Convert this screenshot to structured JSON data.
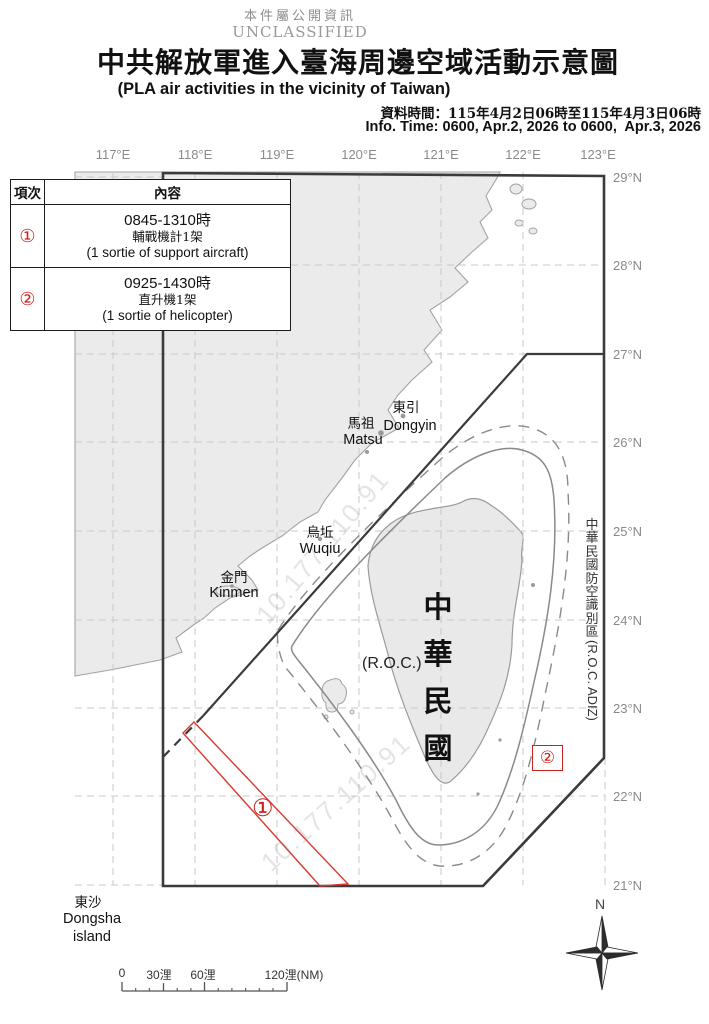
{
  "header": {
    "classification_zh": "本件屬公開資訊",
    "classification_en": "UNCLASSIFIED",
    "title_zh": "中共解放軍進入臺海周邊空域活動示意圖",
    "title_en": "(PLA air activities in the vicinity of Taiwan)",
    "info_time_zh": "資料時間：115年4月2日06時至115年4月3日06時",
    "info_time_en": "Info. Time: 0600, Apr.2, 2026 to 0600,  Apr.3, 2026"
  },
  "activity_table": {
    "col_item": "項次",
    "col_content": "內容",
    "rows": [
      {
        "id": "①",
        "time": "0845-1310時",
        "desc_zh": "輔戰機計1架",
        "desc_en": "(1 sortie of support aircraft)"
      },
      {
        "id": "②",
        "time": "0925-1430時",
        "desc_zh": "直升機1架",
        "desc_en": "(1 sortie of helicopter)"
      }
    ]
  },
  "map": {
    "lon_labels": [
      "117°E",
      "118°E",
      "119°E",
      "120°E",
      "121°E",
      "122°E",
      "123°E"
    ],
    "lat_labels": [
      "29°N",
      "28°N",
      "27°N",
      "26°N",
      "25°N",
      "24°N",
      "23°N",
      "22°N",
      "21°N"
    ],
    "places": {
      "dongyin_zh": "東引",
      "dongyin_en": "Dongyin",
      "matsu_zh": "馬祖",
      "matsu_en": "Matsu",
      "wuqiu_zh": "烏坵",
      "wuqiu_en": "Wuqiu",
      "kinmen_zh": "金門",
      "kinmen_en": "Kinmen",
      "dongsha_zh": "東沙",
      "dongsha_en1": "Dongsha",
      "dongsha_en2": "island",
      "taiwan_zh": "中華民國",
      "taiwan_en": "(R.O.C.)"
    },
    "adiz_label_zh": "中華民國防空識別區",
    "adiz_label_en": "(R.O.C. ADIZ)",
    "markers": {
      "m1": "①",
      "m2": "②"
    },
    "compass_n": "N",
    "watermark": "10.177.110.91",
    "scale": {
      "t0": "0",
      "t30": "30浬",
      "t60": "60浬",
      "t120": "120浬(NM)"
    }
  },
  "colors": {
    "red": "#cf2020",
    "land": "#ebebeb",
    "grid": "#c8c8c8",
    "boundary": "#3b3b3b"
  }
}
